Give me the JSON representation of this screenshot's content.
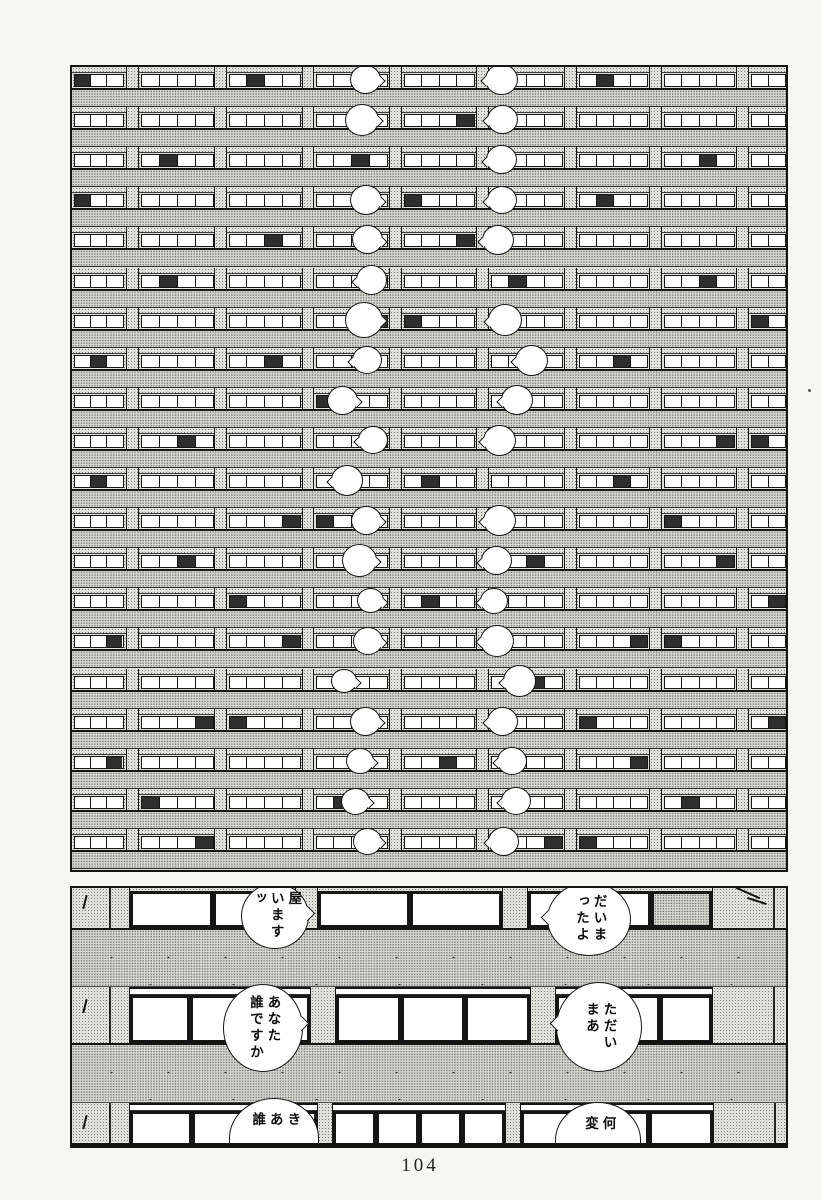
{
  "page": {
    "number": "104",
    "ink": "#141414",
    "paper": "#f6f6f2",
    "tone_light": "#c9c9c6",
    "tone_slab": "#bfbfbc"
  },
  "top_panel": {
    "x": 70,
    "y": 65,
    "w": 718,
    "h": 807,
    "border": 2.5,
    "floors": 20,
    "floor_h": 40.1,
    "strips": [
      [
        74,
        50
      ],
      [
        141,
        73
      ],
      [
        229,
        72
      ],
      [
        316,
        72
      ],
      [
        404,
        71
      ],
      [
        491,
        72
      ],
      [
        579,
        69
      ],
      [
        664,
        71
      ],
      [
        751,
        35
      ]
    ],
    "dividers": [
      [
        126,
        13
      ],
      [
        214,
        13
      ],
      [
        302,
        12
      ],
      [
        389,
        13
      ],
      [
        476,
        13
      ],
      [
        564,
        13
      ],
      [
        649,
        13
      ],
      [
        736,
        13
      ]
    ],
    "balloons": [
      [
        366,
        83,
        31,
        "r"
      ],
      [
        362,
        121,
        34,
        "r"
      ],
      [
        366,
        200,
        32,
        "r"
      ],
      [
        368,
        242,
        31,
        "r"
      ],
      [
        372,
        281,
        31,
        "l"
      ],
      [
        364,
        321,
        38,
        "r"
      ],
      [
        367,
        366,
        30,
        "l"
      ],
      [
        343,
        406,
        31,
        "r"
      ],
      [
        373,
        450,
        30,
        "l"
      ],
      [
        347,
        489,
        32,
        "l"
      ],
      [
        367,
        528,
        31,
        "r"
      ],
      [
        360,
        568,
        35,
        "r"
      ],
      [
        371,
        608,
        27,
        "r"
      ],
      [
        368,
        645,
        30,
        "r"
      ],
      [
        344,
        680,
        26,
        "r"
      ],
      [
        366,
        718,
        31,
        "r"
      ],
      [
        360,
        757,
        28,
        "r"
      ],
      [
        356,
        795,
        29,
        "r"
      ],
      [
        368,
        838,
        29,
        "r"
      ],
      [
        502,
        79,
        33,
        "l"
      ],
      [
        503,
        122,
        31,
        "l"
      ],
      [
        502,
        160,
        31,
        "l"
      ],
      [
        502,
        199,
        30,
        "l"
      ],
      [
        498,
        239,
        32,
        "l"
      ],
      [
        505,
        320,
        34,
        "l"
      ],
      [
        532,
        358,
        33,
        "l"
      ],
      [
        517,
        404,
        32,
        "l"
      ],
      [
        500,
        448,
        33,
        "l"
      ],
      [
        500,
        525,
        33,
        "l"
      ],
      [
        497,
        563,
        31,
        "l"
      ],
      [
        494,
        604,
        28,
        "l"
      ],
      [
        497,
        640,
        34,
        "l"
      ],
      [
        520,
        679,
        33,
        "l"
      ],
      [
        503,
        717,
        31,
        "l"
      ],
      [
        512,
        757,
        30,
        "l"
      ],
      [
        516,
        794,
        30,
        "l"
      ],
      [
        504,
        836,
        31,
        "l"
      ]
    ]
  },
  "bottom_panel": {
    "x": 70,
    "y": 886,
    "w": 718,
    "h": 262,
    "border": 2.5,
    "wall_left_w": 58,
    "rows": [
      {
        "type": "win",
        "y": 0,
        "h": 42,
        "head": false,
        "groups": [
          {
            "x": 58,
            "w": 165,
            "panes": 2
          },
          {
            "x": 246,
            "w": 184,
            "panes": 2
          },
          {
            "x": 456,
            "w": 184,
            "panes": 3,
            "tone_last": true
          }
        ],
        "dividers": [
          {
            "x": 223,
            "w": 23
          },
          {
            "x": 430,
            "w": 26
          }
        ],
        "wall_right": {
          "x": 640,
          "w": 75,
          "cracks": true
        }
      },
      {
        "type": "slab",
        "y": 42,
        "h": 57
      },
      {
        "type": "win",
        "y": 99,
        "h": 58,
        "head": true,
        "groups": [
          {
            "x": 58,
            "w": 180,
            "panes": 3
          },
          {
            "x": 264,
            "w": 194,
            "panes": 3
          },
          {
            "x": 484,
            "w": 156,
            "panes": 3
          }
        ],
        "dividers": [
          {
            "x": 238,
            "w": 26
          },
          {
            "x": 458,
            "w": 26
          }
        ],
        "wall_right": {
          "x": 640,
          "w": 75,
          "cracks": false
        }
      },
      {
        "type": "slab",
        "y": 157,
        "h": 58
      },
      {
        "type": "win",
        "y": 215,
        "h": 45,
        "head": true,
        "groups": [
          {
            "x": 58,
            "w": 187,
            "panes": 3
          },
          {
            "x": 261,
            "w": 172,
            "panes": 4
          },
          {
            "x": 449,
            "w": 192,
            "panes": 3
          }
        ],
        "dividers": [
          {
            "x": 245,
            "w": 16
          },
          {
            "x": 433,
            "w": 16
          }
        ],
        "wall_right": {
          "x": 641,
          "w": 74,
          "cracks": false
        }
      }
    ],
    "bubbles": [
      {
        "cx": 203,
        "cy": 28,
        "rx": 34,
        "ry": 33,
        "tail": "right",
        "dome": false,
        "lines": [
          "屋",
          "います",
          "ッ"
        ]
      },
      {
        "cx": 517,
        "cy": 31,
        "rx": 42,
        "ry": 37,
        "tail": "left",
        "dome": false,
        "lines": [
          "だいま",
          "ったよ"
        ]
      },
      {
        "cx": 191,
        "cy": 140,
        "rx": 40,
        "ry": 44,
        "tail": "right",
        "dome": false,
        "lines": [
          "あなた",
          "誰ですか"
        ]
      },
      {
        "cx": 527,
        "cy": 139,
        "rx": 43,
        "ry": 45,
        "tail": "left",
        "dome": false,
        "lines": [
          "ただい",
          "まあ"
        ]
      },
      {
        "cx": 202,
        "cy": 250,
        "rx": 45,
        "ry": 40,
        "tail": "none",
        "dome": true,
        "lines": [
          "き",
          "あ",
          "誰"
        ]
      },
      {
        "cx": 526,
        "cy": 252,
        "rx": 43,
        "ry": 38,
        "tail": "none",
        "dome": true,
        "lines": [
          "何",
          "変"
        ]
      }
    ]
  }
}
